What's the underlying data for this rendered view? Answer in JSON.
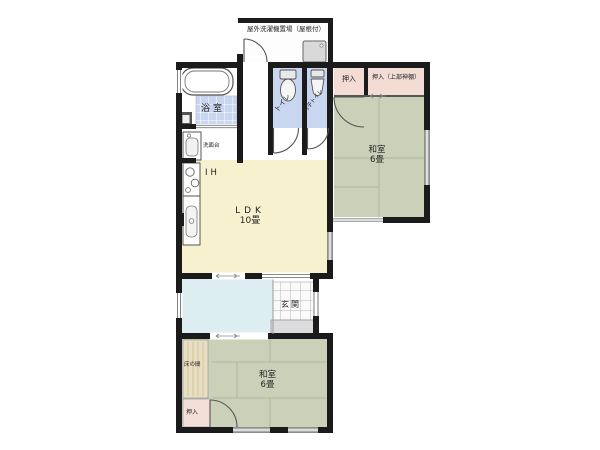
{
  "title": "floor-plan",
  "labels": {
    "outdoor_laundry": "屋外洗濯機置場（屋根付）",
    "bathroom": "浴室",
    "washbasin": "洗面台",
    "toilet": "トイレ",
    "mens_toilet": "男子トイレ",
    "closet_a": "押入",
    "closet_b": "押入（上部神棚）",
    "washitsu_right_name": "和室",
    "washitsu_right_size": "6畳",
    "ih": "IH",
    "ldk_name": "LDK",
    "ldk_size": "10畳",
    "genkan": "玄関",
    "tokonoma": "床の間",
    "washitsu_bottom_name": "和室",
    "washitsu_bottom_size": "6畳",
    "closet_bottom": "押入"
  },
  "colors": {
    "wall": "#1b1b1b",
    "tatami": "#cbd1b9",
    "tatami_line": "#aeb69c",
    "ldk_floor": "#f8f1cf",
    "wet_floor_blue": "#c9d6f0",
    "hall_cyan": "#dceef1",
    "closet_pink": "#f2dcd4",
    "tokonoma_wood": "#e8dfc2",
    "genkan_tile": "#fafafa",
    "porch_gray": "#dcdcde"
  }
}
